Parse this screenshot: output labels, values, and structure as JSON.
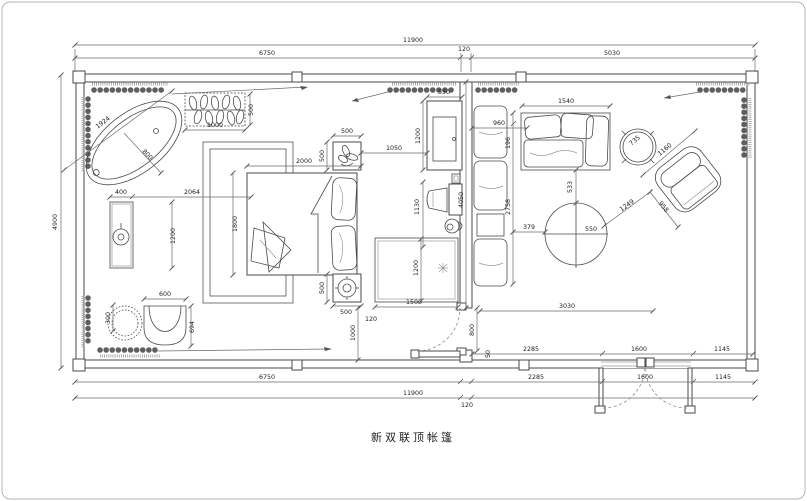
{
  "title": "新双联顶帐篷",
  "dims": {
    "top_total": "11900",
    "top_left": "6750",
    "top_mid": "120",
    "top_right": "5030",
    "left_height": "4900",
    "bottom_left": "6750",
    "bottom_total": "11900",
    "bottom_mid": "120",
    "bottom_a": "2285",
    "bottom_b": "1600",
    "bottom_c": "1145",
    "inner_a": "2285",
    "inner_b": "1600",
    "inner_c": "1145",
    "living_width": "3030",
    "tub_diagonal": "1924",
    "tub_radius": "800",
    "plant_width": "1000",
    "plant_height": "500",
    "basin_width": "400",
    "basin_gap": "2064",
    "basin_length": "1200",
    "stool_diameter": "300",
    "tub_chair_width": "600",
    "tub_chair_height": "694",
    "rug_height": "1800",
    "bed_width": "2000",
    "nightstand_top_width": "500",
    "nightstand_top_height": "500",
    "nightstand_bottom_height": "500",
    "nightstand_bottom_width": "500",
    "nightstand_gap": "120",
    "nightstand_to_wall": "1000",
    "cabinet_width": "550",
    "cabinet_height": "1200",
    "cabinet_gap": "1050",
    "desk_chair": "1130",
    "grid_rug_width": "1500",
    "grid_rug_height": "1200",
    "door_height": "800",
    "door_gap": "50",
    "sofa_depth": "960",
    "sofa_top_width": "1540",
    "sofa_segment": "196",
    "sofa_length": "2758",
    "partition_length": "4050",
    "table_offset_top": "533",
    "table_radius": "550",
    "table_offset_left": "379",
    "side_table": "735",
    "armchair_d1": "1160",
    "armchair_d2": "1249",
    "armchair_d3": "958"
  }
}
